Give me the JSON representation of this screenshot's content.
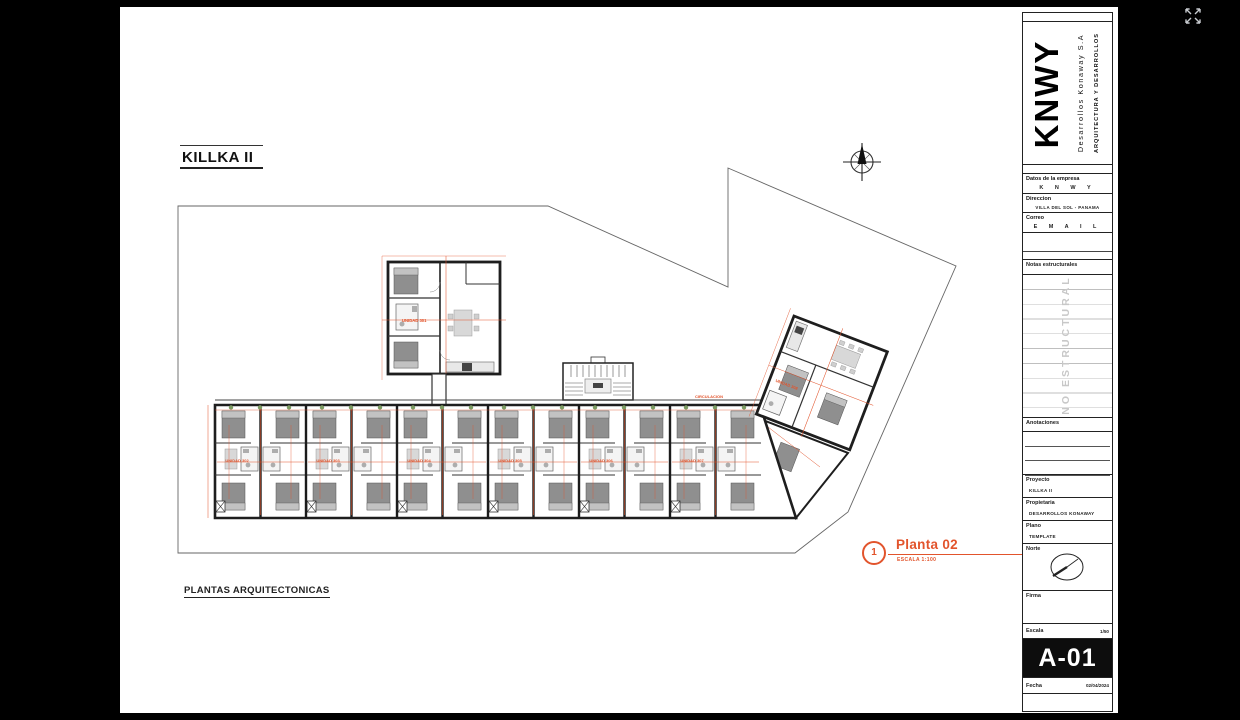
{
  "viewer": {
    "icons": {
      "fullscreen": "expand-arrows"
    }
  },
  "sheet": {
    "title": "KILLKA II",
    "footer_title": "PLANTAS ARQUITECTONICAS",
    "callout": {
      "number": "1",
      "title": "Planta 02",
      "scale": "ESCALA 1:100"
    }
  },
  "plan": {
    "units": [
      "UNIDAD 301",
      "UNIDAD 302",
      "UNIDAD 303",
      "UNIDAD 304",
      "UNIDAD 305",
      "UNIDAD 306",
      "UNIDAD 307",
      "UNIDAD 308"
    ],
    "circulation": "CIRCULACION"
  },
  "titleblock": {
    "logo": "KNWY",
    "company": "Desarrollos Konaway S.A",
    "tagline": "ARQUITECTURA Y DESARROLLOS",
    "company_label": "Datos de la empresa",
    "company_value": "K N W Y",
    "address_label": "Direccion",
    "address_value": "VILLA DEL SOL - PANAMA",
    "email_label": "Correo",
    "email_value": "E M A I L",
    "notes_label": "Notas estructurales",
    "notes_watermark": "NO ESTRUCTURAL",
    "annotations_label": "Anotaciones",
    "project_label": "Proyecto",
    "project_value": "KILLKA II",
    "owner_label": "Propietaria",
    "owner_value": "DESARROLLOS KONAWAY",
    "plan_label": "Plano",
    "plan_value": "TEMPLATE",
    "north_label": "Norte",
    "signature_label": "Firma",
    "scale_label": "Escala",
    "scale_value": "1/50",
    "sheet_number": "A-01",
    "date_label": "Fecha",
    "date_value": "02/04/2024"
  },
  "colors": {
    "accent": "#E2542C",
    "paper": "#FFFFFF",
    "ink": "#1E1E1E",
    "watermark": "#C8C8C8"
  }
}
